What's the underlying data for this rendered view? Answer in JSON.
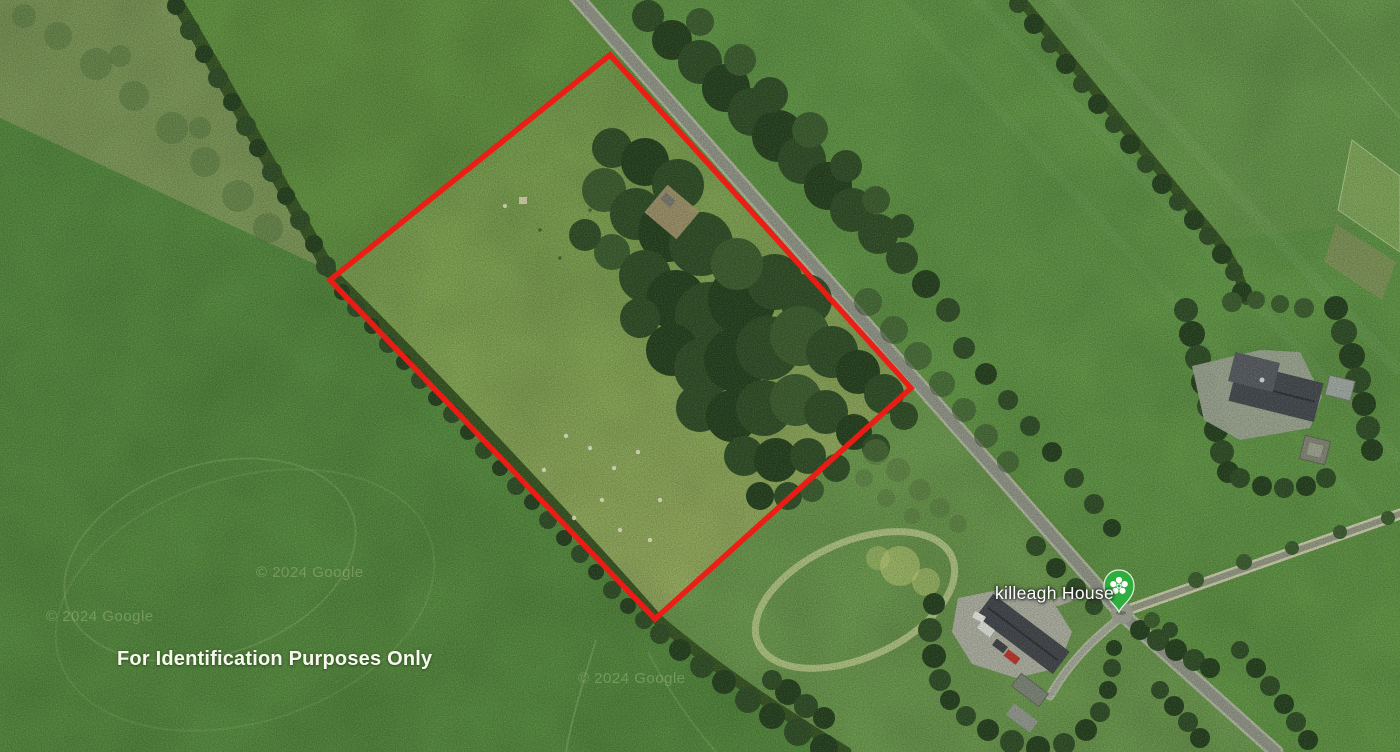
{
  "map": {
    "disclaimer": "For Identification Purposes Only",
    "place_label": "killeagh House",
    "watermark": "© 2024 Google",
    "boundary": {
      "points": "610,55 911,388 655,619 330,280",
      "color": "#f01b15"
    },
    "pin": {
      "icon": "flower-place-pin-icon",
      "color": "#2fae3e"
    }
  }
}
